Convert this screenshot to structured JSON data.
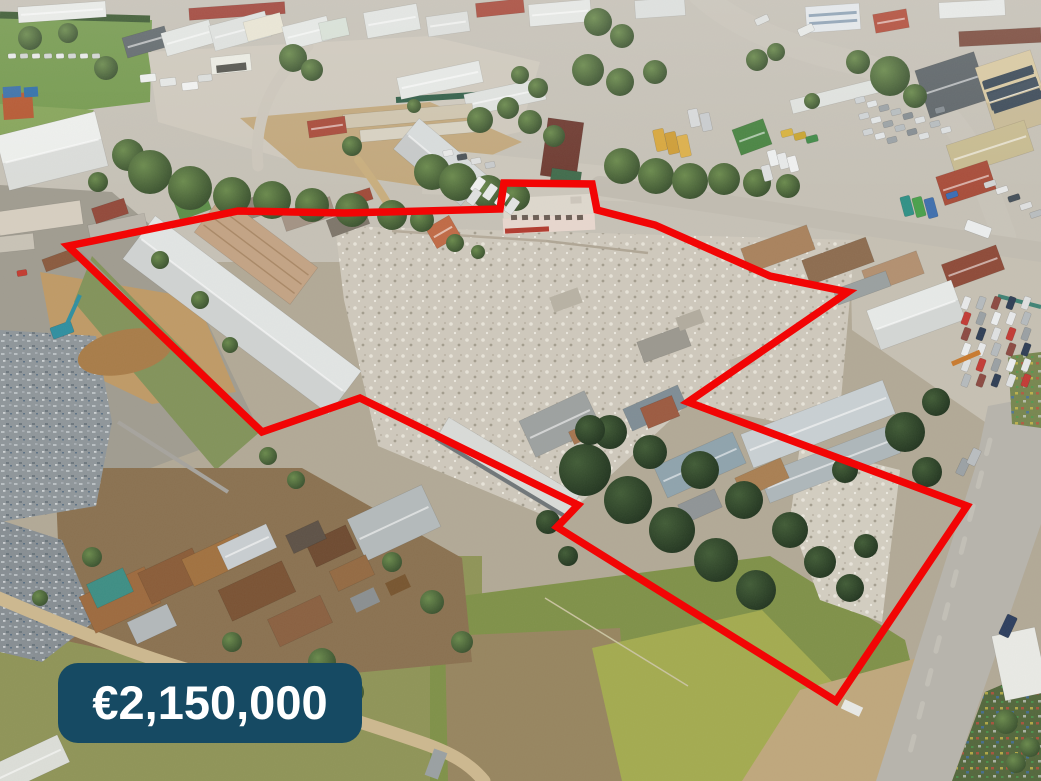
{
  "image": {
    "kind": "aerial-drone-photo",
    "subject": "industrial land plot with demolished buildings outlined for sale",
    "width_px": 1041,
    "height_px": 781
  },
  "overlay": {
    "price_badge": {
      "label": "€2,150,000",
      "background_color": "#164a63",
      "text_color": "#ffffff",
      "x": 58,
      "y": 663,
      "width": 304,
      "height": 80,
      "corner_radius": 20
    },
    "property_boundary": {
      "color": "#f20505",
      "stroke_width": 7.5,
      "points": [
        [
          68,
          246
        ],
        [
          238,
          211
        ],
        [
          345,
          213
        ],
        [
          500,
          209
        ],
        [
          504,
          183
        ],
        [
          592,
          184
        ],
        [
          597,
          210
        ],
        [
          655,
          225
        ],
        [
          770,
          276
        ],
        [
          848,
          292
        ],
        [
          688,
          402
        ],
        [
          967,
          506
        ],
        [
          836,
          701
        ],
        [
          557,
          527
        ],
        [
          578,
          505
        ],
        [
          360,
          398
        ],
        [
          262,
          432
        ]
      ]
    }
  }
}
